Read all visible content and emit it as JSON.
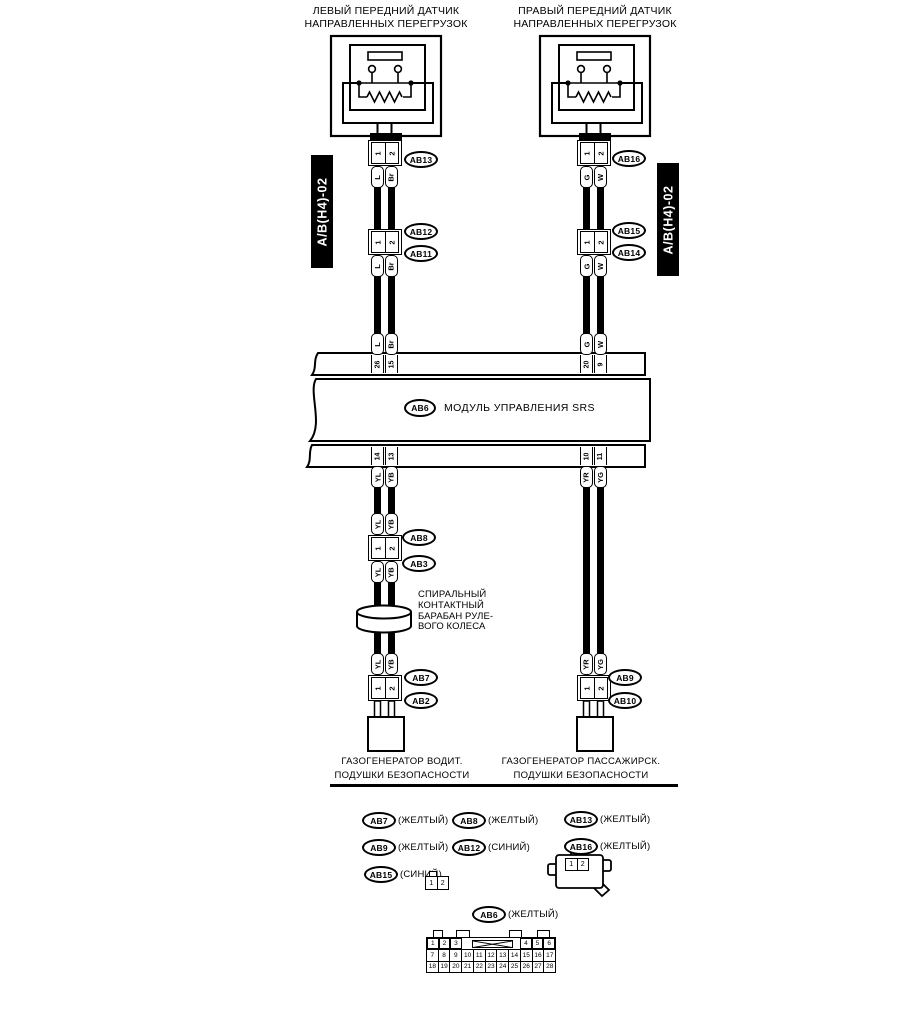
{
  "module": {
    "tag": "AB6",
    "label": "МОДУЛЬ УПРАВЛЕНИЯ SRS"
  },
  "left_branch": {
    "title": [
      "ЛЕВЫЙ ПЕРЕДНИЙ ДАТЧИК",
      "НАПРАВЛЕННЫХ ПЕРЕГРУЗОК"
    ],
    "harness_tag": "A/B(H4)-02",
    "sensor_conn": {
      "pins": [
        "1",
        "2"
      ],
      "tag": "AB13"
    },
    "wire_upper": [
      "L",
      "Br"
    ],
    "inline_conn": {
      "pins": [
        "1",
        "2"
      ],
      "tag_top": "AB12",
      "tag_bottom": "AB11"
    },
    "module_pins_in": [
      "26",
      "15"
    ],
    "module_pins_out": [
      "14",
      "13"
    ],
    "wire_lower": [
      "YL",
      "YB"
    ],
    "drum_conn": {
      "pins": [
        "1",
        "2"
      ],
      "tag_top": "AB8",
      "tag_bottom": "AB3"
    },
    "drum_label": [
      "СПИРАЛЬНЫЙ",
      "КОНТАКТНЫЙ",
      "БАРАБАН РУЛЕ-",
      "ВОГО КОЛЕСА"
    ],
    "squib_conn": {
      "pins": [
        "1",
        "2"
      ],
      "tag_top": "AB7",
      "tag_bottom": "AB2"
    },
    "load_label": [
      "ГАЗОГЕНЕРАТОР ВОДИТ.",
      "ПОДУШКИ БЕЗОПАСНОСТИ"
    ]
  },
  "right_branch": {
    "title": [
      "ПРАВЫЙ ПЕРЕДНИЙ ДАТЧИК",
      "НАПРАВЛЕННЫХ ПЕРЕГРУЗОК"
    ],
    "harness_tag": "A/B(H4)-02",
    "sensor_conn": {
      "pins": [
        "1",
        "2"
      ],
      "tag": "AB16"
    },
    "wire_upper": [
      "G",
      "W"
    ],
    "inline_conn": {
      "pins": [
        "1",
        "2"
      ],
      "tag_top": "AB15",
      "tag_bottom": "AB14"
    },
    "module_pins_in": [
      "20",
      "9"
    ],
    "module_pins_out": [
      "10",
      "11"
    ],
    "wire_lower": [
      "YR",
      "YG"
    ],
    "squib_conn": {
      "pins": [
        "1",
        "2"
      ],
      "tag_top": "AB9",
      "tag_bottom": "AB10"
    },
    "load_label": [
      "ГАЗОГЕНЕРАТОР ПАССАЖИРСК.",
      "ПОДУШКИ БЕЗОПАСНОСТИ"
    ]
  },
  "legend": {
    "items": [
      {
        "tag": "AB7",
        "color": "(ЖЕЛТЫЙ)"
      },
      {
        "tag": "AB8",
        "color": "(ЖЕЛТЫЙ)"
      },
      {
        "tag": "AB13",
        "color": "(ЖЕЛТЫЙ)"
      },
      {
        "tag": "AB9",
        "color": "(ЖЕЛТЫЙ)"
      },
      {
        "tag": "AB12",
        "color": "(СИНИЙ)"
      },
      {
        "tag": "AB16",
        "color": "(ЖЕЛТЫЙ)"
      },
      {
        "tag": "AB15",
        "color": "(СИНИЙ)"
      }
    ],
    "conn2_small_pins": [
      "1",
      "2"
    ],
    "conn2_housing_pins": [
      "1",
      "2"
    ],
    "ab6": {
      "tag": "AB6",
      "color": "(ЖЕЛТЫЙ)"
    },
    "ab6_pins": {
      "row1_left": [
        "1",
        "2",
        "3"
      ],
      "row1_right": [
        "4",
        "5",
        "6"
      ],
      "row2": [
        "7",
        "8",
        "9",
        "10",
        "11",
        "12",
        "13",
        "14",
        "15",
        "16",
        "17"
      ],
      "row3": [
        "18",
        "19",
        "20",
        "21",
        "22",
        "23",
        "24",
        "25",
        "26",
        "27",
        "28"
      ]
    }
  }
}
